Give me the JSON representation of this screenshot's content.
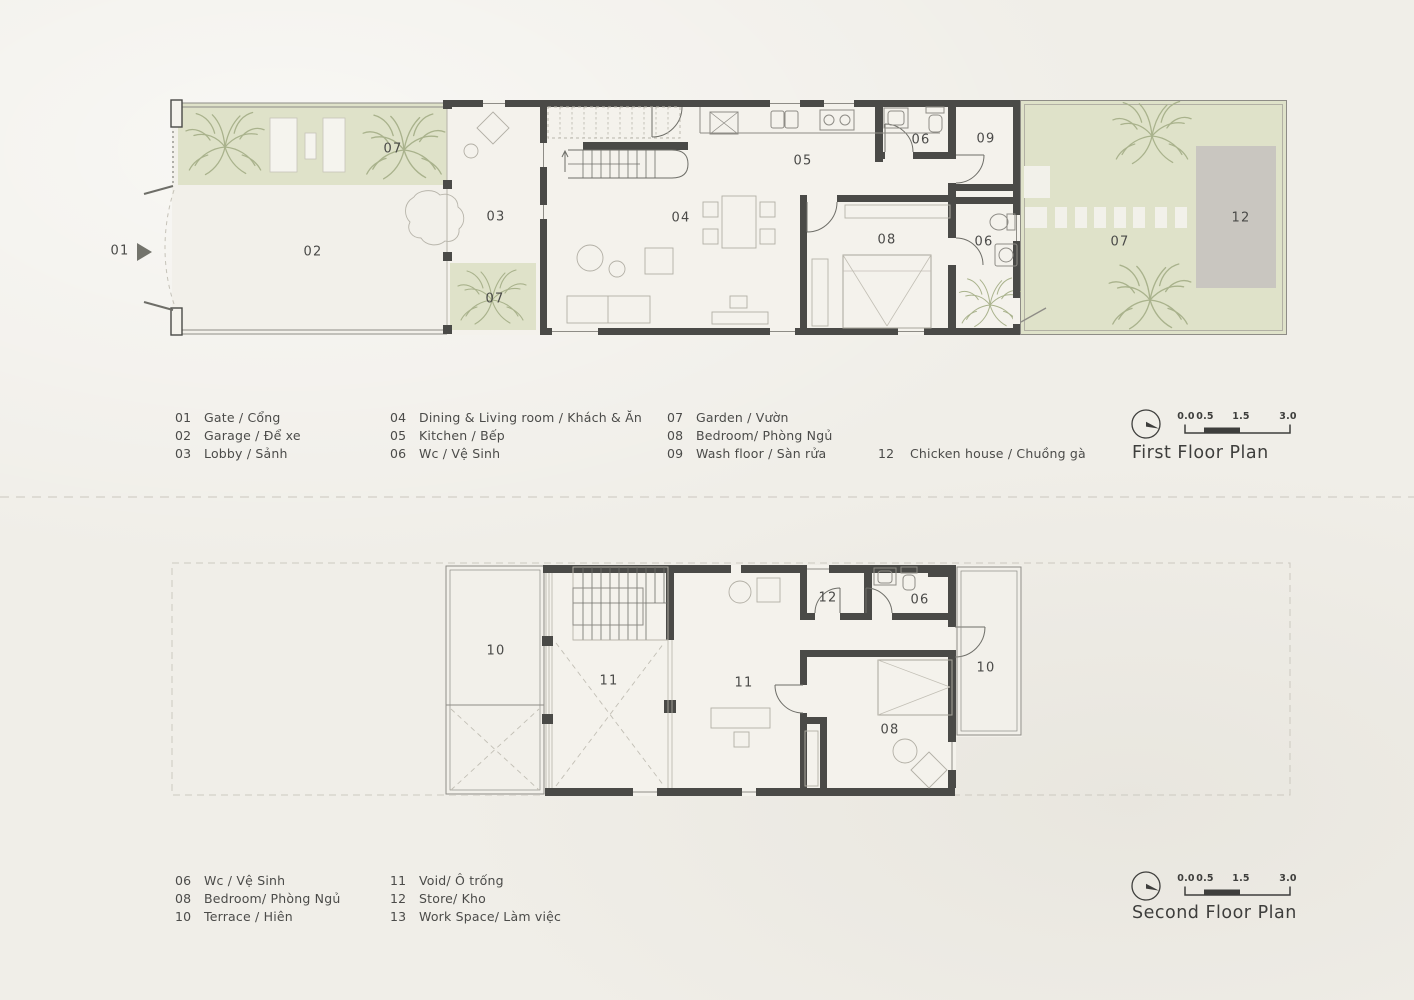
{
  "sheet": {
    "type": "architecture floor plan drawing",
    "colors": {
      "background": "#f0eee8",
      "garden_green": "#dfe2c9",
      "wall_dark": "#4a4a47",
      "chicken_house_gray": "#c9c6c0",
      "tree_stroke": "#a9b28c",
      "text": "#4b4b49"
    }
  },
  "first_floor": {
    "title": "First Floor Plan",
    "scale_ticks": [
      "0.0",
      "0.5",
      "1.5",
      "3.0"
    ],
    "rooms": {
      "gate": "01",
      "garage": "02",
      "lobby": "03",
      "dining_living": "04",
      "kitchen": "05",
      "wc_a": "06",
      "wc_b": "06",
      "garden_a": "07",
      "garden_b": "07",
      "garden_c": "07",
      "bedroom": "08",
      "wash_floor": "09",
      "chicken_house": "12"
    },
    "legend": {
      "col1": [
        {
          "num": "01",
          "label": "Gate / Cổng"
        },
        {
          "num": "02",
          "label": "Garage / Để xe"
        },
        {
          "num": "03",
          "label": "Lobby / Sảnh"
        }
      ],
      "col2": [
        {
          "num": "04",
          "label": "Dining & Living room / Khách & Ăn"
        },
        {
          "num": "05",
          "label": "Kitchen / Bếp"
        },
        {
          "num": "06",
          "label": "Wc / Vệ Sinh"
        }
      ],
      "col3": [
        {
          "num": "07",
          "label": "Garden / Vườn"
        },
        {
          "num": "08",
          "label": "Bedroom/ Phòng Ngủ"
        },
        {
          "num": "09",
          "label": "Wash floor / Sàn rửa"
        }
      ],
      "col4": [
        {
          "num": "12",
          "label": "Chicken house / Chuồng gà"
        }
      ]
    }
  },
  "second_floor": {
    "title": "Second Floor Plan",
    "scale_ticks": [
      "0.0",
      "0.5",
      "1.5",
      "3.0"
    ],
    "rooms": {
      "terrace_a": "10",
      "terrace_b": "10",
      "void_a": "11",
      "void_b": "11",
      "store": "12",
      "wc": "06",
      "bedroom": "08"
    },
    "legend": {
      "col1": [
        {
          "num": "06",
          "label": "Wc / Vệ Sinh"
        },
        {
          "num": "08",
          "label": "Bedroom/ Phòng Ngủ"
        },
        {
          "num": "10",
          "label": "Terrace / Hiên"
        }
      ],
      "col2": [
        {
          "num": "11",
          "label": "Void/ Ô trống"
        },
        {
          "num": "12",
          "label": "Store/ Kho"
        },
        {
          "num": "13",
          "label": "Work Space/  Làm việc"
        }
      ]
    }
  }
}
